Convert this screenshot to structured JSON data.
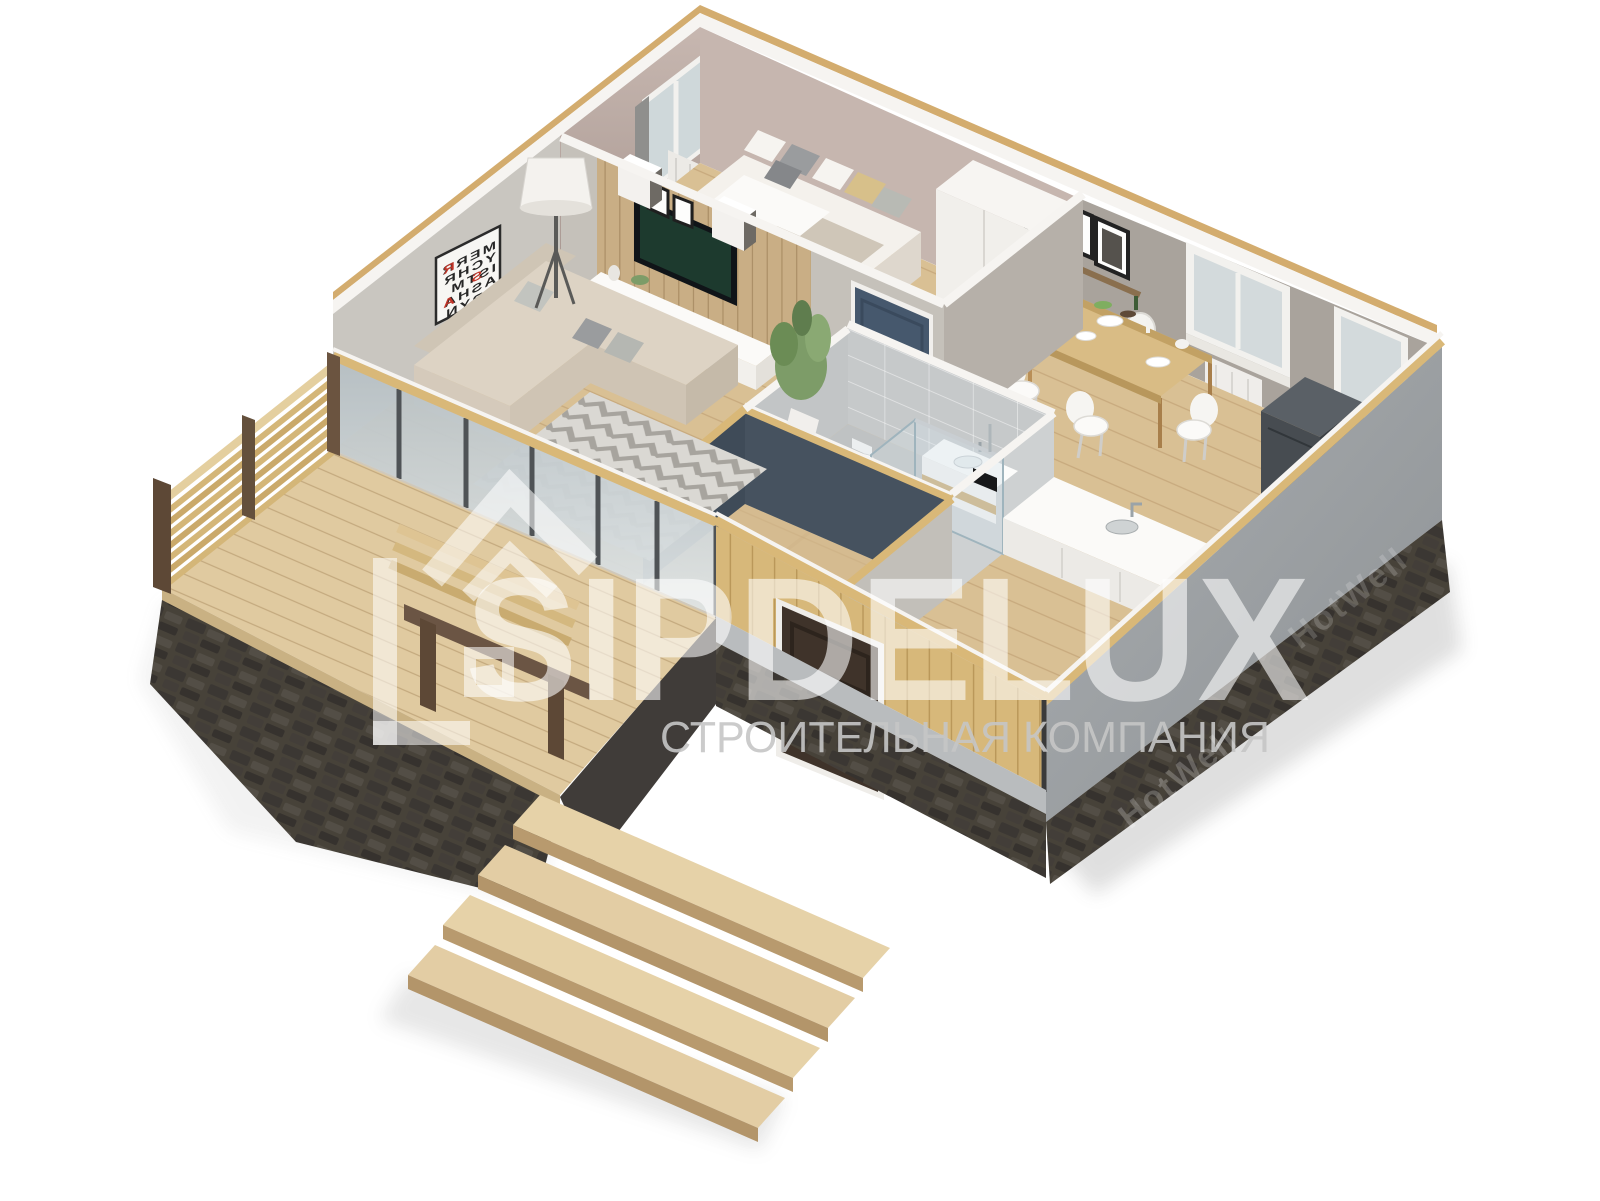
{
  "scene": {
    "description": "isometric 3d cutaway floor plan render of a one-storey house",
    "background": "#ffffff"
  },
  "watermark": {
    "brand": "SIPDELUX",
    "tagline": "СТРОИТЕЛЬНАЯ КОМПАНИЯ",
    "logo_icon": "house-outline-icon",
    "brand_color": "rgba(255,255,255,0.58)",
    "tagline_color": "#c6c6c6"
  },
  "foundation_watermark": {
    "text": "HotWell"
  },
  "poster": {
    "lines": [
      "MERR",
      "YCHR",
      "ISTM",
      "ASHA",
      "PPYN",
      "YEAR"
    ],
    "mirrored": true,
    "accent_color": "#c13327",
    "accents": [
      {
        "char": "R"
      },
      {
        "char": "S"
      },
      {
        "char": "A"
      },
      {
        "char": "P"
      }
    ]
  },
  "palette": {
    "floor_wood": "#d9c094",
    "deck_wood": "#e0caa0",
    "bedroom_wall": "#b9a8a1",
    "kitchen_wall": "#a9a39c",
    "living_wall": "#c9c6c0",
    "slat_wall": "#c9ae85",
    "hall_wall": "#46525f",
    "bathroom_tile": "#c6c9ca",
    "bedroom_door": "#46586d",
    "entrance_door": "#3f332a",
    "cladding_wood": "#d7b87a",
    "stucco": "#9ea2a5",
    "foundation_stone": "#474239",
    "fence_wood": "#d4b678",
    "white_trim": "#f6f4f1"
  },
  "rooms": [
    {
      "name": "bedroom"
    },
    {
      "name": "living-room"
    },
    {
      "name": "kitchen-dining"
    },
    {
      "name": "bathroom"
    },
    {
      "name": "hallway"
    },
    {
      "name": "terrace"
    }
  ]
}
